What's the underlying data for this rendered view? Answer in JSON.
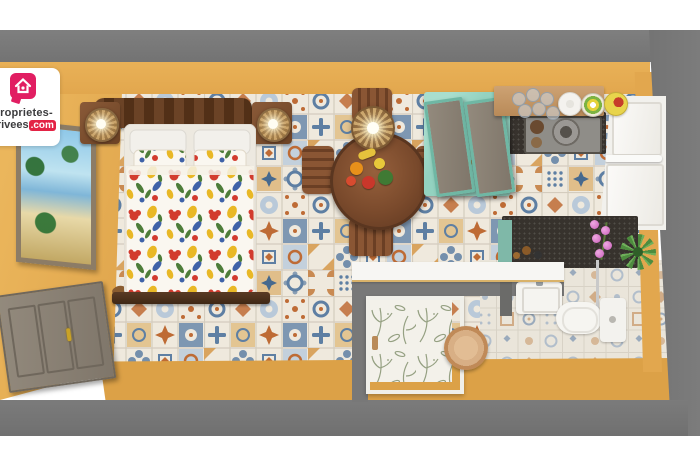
{
  "watermark": {
    "line1": "proprietes-",
    "line2": "privees",
    "tld": ".com"
  },
  "palette": {
    "background": "#FFFFFF",
    "wall_outer_gray": "#787878",
    "wall_inner_yellow": "#E6AD55",
    "floor_cream": "#EFE9DD",
    "tile_blue": "#5E7FA3",
    "tile_light_blue": "#A9BCCF",
    "tile_rust": "#BE6B35",
    "tile_tan": "#D9A45F",
    "mint_cabinet": "#93D2C0",
    "wood_dark": "#5C3A24",
    "wood_mid": "#7C4B2E",
    "wood_light": "#C59A6A",
    "counter_dark": "#37322D",
    "white_fixture": "#F2F1ED",
    "brand_pink": "#E11E62",
    "brand_red": "#E32345",
    "text_dark": "#3C3C3E",
    "duvet_red": "#D23B2E",
    "duvet_yellow": "#E9B826",
    "duvet_blue": "#3F62A8",
    "duvet_green": "#4E7D3A",
    "orchid_pink": "#D879C8",
    "plant_green": "#4E8C3F"
  },
  "inventory": {
    "bedroom": [
      "carved-headboard",
      "double-bed",
      "white-pillows",
      "floral-pillows",
      "floral-duvet",
      "nightstand-left",
      "rattan-lamp-left",
      "nightstand-right",
      "rattan-lamp-right",
      "bed-end-bench"
    ],
    "dining": [
      "round-wood-table",
      "dining-chair-top",
      "dining-chair-left",
      "dining-chair-right",
      "dining-chair-bottom",
      "rattan-pendant-lamp",
      "fruit-centerpiece"
    ],
    "kitchen": [
      "mint-wall-cabinet",
      "open-wood-shelf",
      "drinking-glasses",
      "white-plate",
      "striped-plate",
      "yellow-bowl",
      "dark-counter",
      "cooktop",
      "frying-pan",
      "tall-white-cabinet"
    ],
    "bathroom": [
      "granite-vanity",
      "orchid",
      "potted-plant",
      "mirror",
      "wall-sink",
      "toilet",
      "shower-enclosure",
      "wooden-stool"
    ],
    "walls": [
      "entry-door",
      "tropical-painting",
      "watermark-logo"
    ]
  }
}
